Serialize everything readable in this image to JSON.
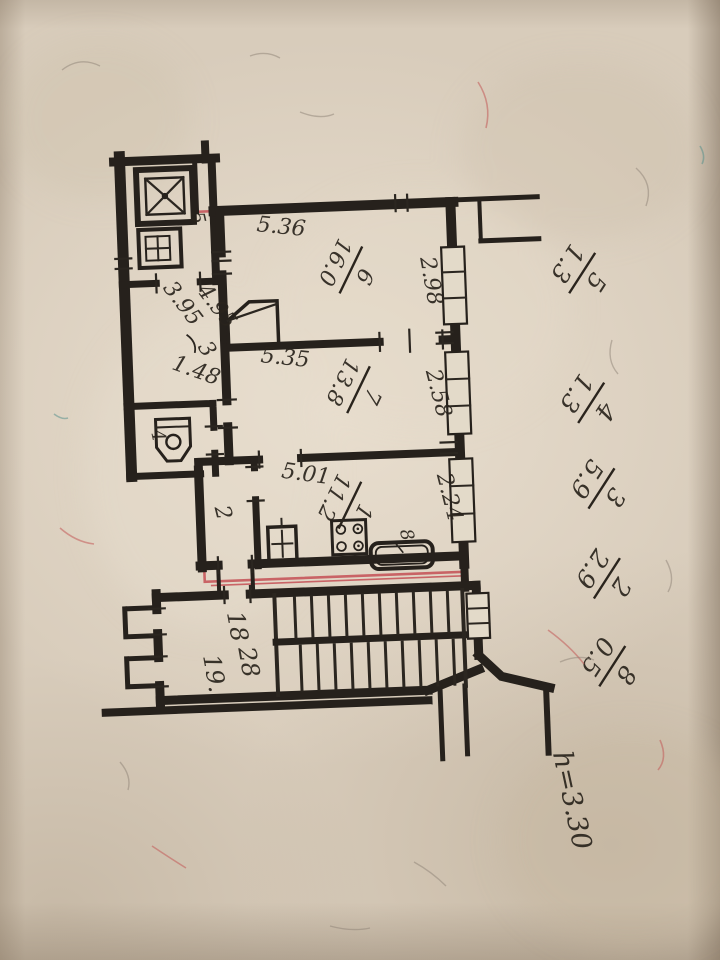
{
  "plan": {
    "dims": {
      "top6": "5.36",
      "right6": "2.98",
      "top7": "5.35",
      "right7": "2.58",
      "top1": "5.01",
      "right1": "2.24",
      "hall_a": "4.95",
      "hall_b": "3.95",
      "hall_c": "1.48"
    },
    "rooms": [
      {
        "number": "6",
        "area": "16.0"
      },
      {
        "number": "7",
        "area": "13.8"
      },
      {
        "number": "1",
        "area": "11.2"
      }
    ],
    "loose": {
      "r2": "2",
      "r3": "3",
      "r4": "4",
      "r5": "5",
      "r8": "8"
    },
    "stairwell": {
      "labels": [
        "18",
        "28",
        "19."
      ]
    },
    "explication": [
      {
        "number": "5",
        "area": "1.3"
      },
      {
        "number": "4",
        "area": "1.3"
      },
      {
        "number": "3",
        "area": "5.9"
      },
      {
        "number": "2",
        "area": "2.9"
      },
      {
        "number": "8",
        "area": "0.5"
      }
    ],
    "ceiling_height": "h=3.30"
  }
}
